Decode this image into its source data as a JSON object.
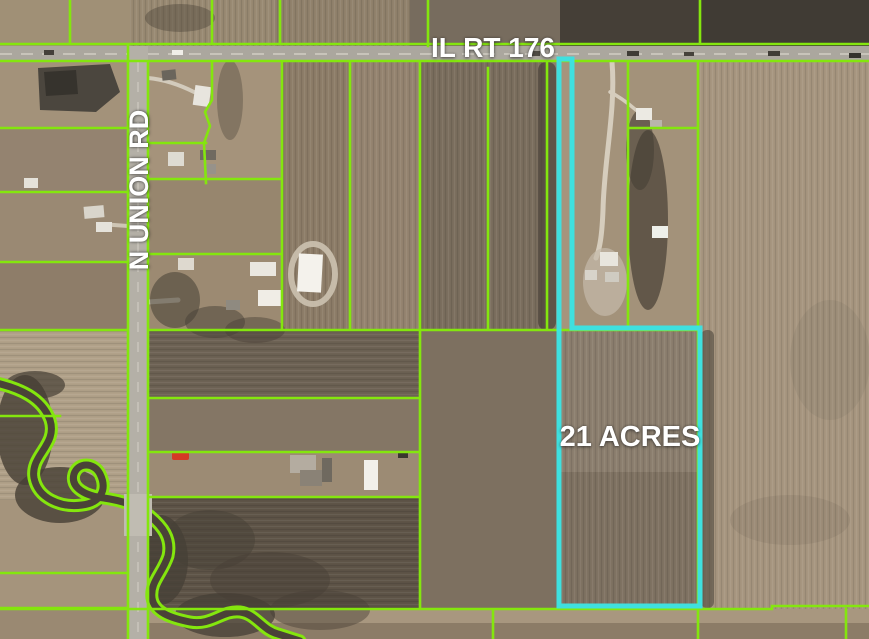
{
  "map": {
    "description": "Aerial parcel map of 21-acre farmland listing",
    "labels": {
      "highway": "IL RT 176",
      "road": "N UNION RD",
      "parcel": "21 ACRES"
    },
    "colors": {
      "parcel_line": "#84e60e",
      "highlight": "#3fe0df",
      "road": "#aba79e",
      "road_secondary": "#b4b0a7",
      "bridge": "#c0bcb2",
      "creek": "#4a4238",
      "label": "#ffffff",
      "truck_red": "#d43a26"
    }
  }
}
